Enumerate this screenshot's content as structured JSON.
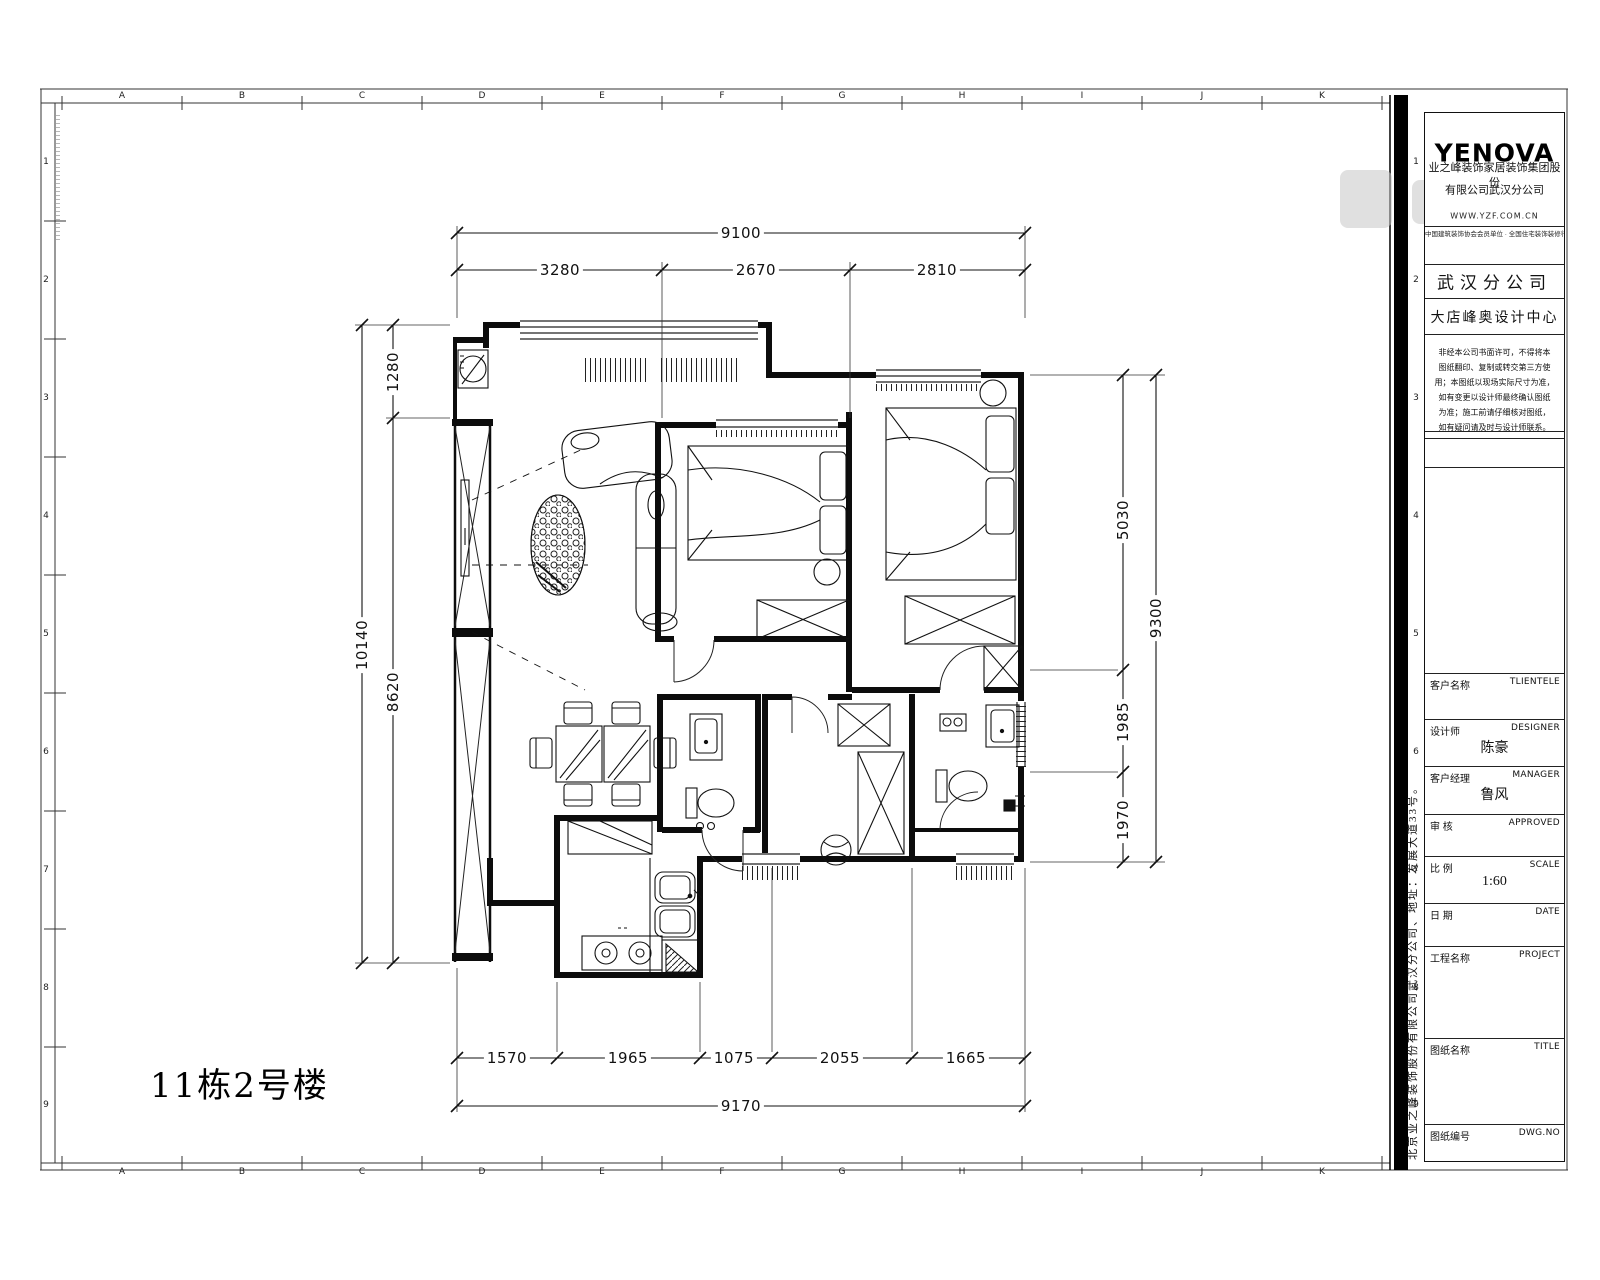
{
  "sheet": {
    "plan_title": "11栋2号楼"
  },
  "grid": {
    "letters": [
      "A",
      "B",
      "C",
      "D",
      "E",
      "F",
      "G",
      "H",
      "I",
      "J",
      "K"
    ],
    "numbers": [
      "1",
      "2",
      "3",
      "4",
      "5",
      "6",
      "7",
      "8",
      "9"
    ]
  },
  "dims": {
    "top": {
      "total": "9100",
      "segments": [
        "3280",
        "2670",
        "2810"
      ]
    },
    "left": {
      "total": "10140",
      "segments": [
        "1280",
        "8620"
      ]
    },
    "right": {
      "total": "9300",
      "segments": [
        "5030",
        "1985",
        "1970"
      ]
    },
    "bottom": {
      "total": "9170",
      "segments": [
        "1570",
        "1965",
        "1075",
        "2055",
        "1665"
      ]
    }
  },
  "titleblock": {
    "logo": "YENOVA",
    "company_line1": "业之峰装饰家居装饰集团股份",
    "company_line2": "有限公司武汉分公司",
    "website": "WWW.YZF.COM.CN",
    "slogan": "中国建筑装饰协会会员单位 · 全国住宅装饰装修行业百强企业",
    "branch": "武汉分公司",
    "design_center": "大店峰奥设计中心",
    "notice_lines": [
      "非经本公司书面许可，不得将本",
      "图纸翻印、复制或转交第三方使",
      "用；本图纸以现场实际尺寸为准，",
      "如有变更以设计师最终确认图纸",
      "为准；施工前请仔细核对图纸，",
      "如有疑问请及时与设计师联系。"
    ],
    "rows": [
      {
        "label": "客户名称",
        "en": "TLIENTELE",
        "value": ""
      },
      {
        "label": "设计师",
        "en": "DESIGNER",
        "value": "陈豪"
      },
      {
        "label": "客户经理",
        "en": "MANAGER",
        "value": "鲁风"
      },
      {
        "label": "审 核",
        "en": "APPROVED",
        "value": ""
      },
      {
        "label": "比 例",
        "en": "SCALE",
        "value": "1:60"
      },
      {
        "label": "日 期",
        "en": "DATE",
        "value": ""
      },
      {
        "label": "工程名称",
        "en": "PROJECT",
        "value": ""
      },
      {
        "label": "图纸名称",
        "en": "TITLE",
        "value": ""
      },
      {
        "label": "图纸编号",
        "en": "DWG.NO",
        "value": ""
      }
    ],
    "side_text": "北京业之峰装饰股份有限公司武汉分公司、地址：发展大道33号。"
  }
}
